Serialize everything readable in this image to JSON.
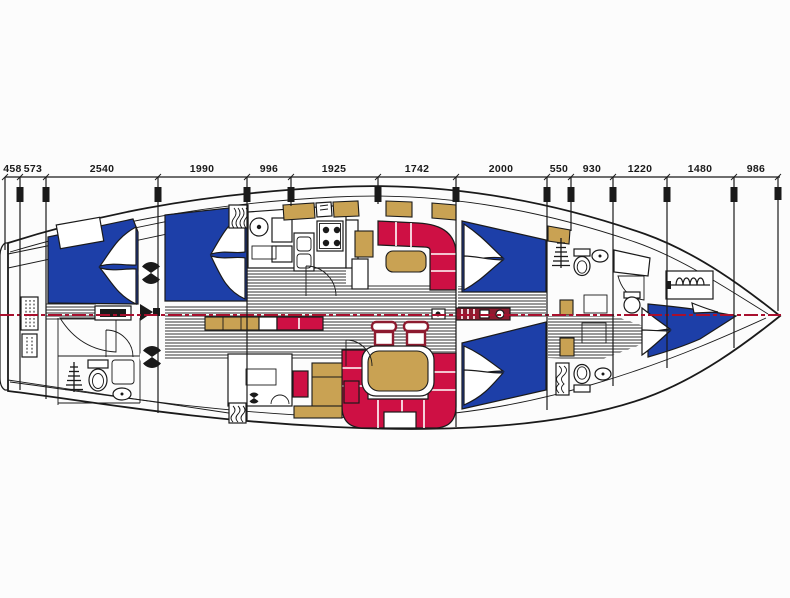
{
  "diagram": {
    "type": "sailing-yacht-interior-layout-plan",
    "view": "top-down",
    "dimension_labels": [
      "458",
      "573",
      "2540",
      "1990",
      "996",
      "1925",
      "1742",
      "2000",
      "550",
      "930",
      "1220",
      "1480",
      "986"
    ],
    "icons": [
      "helm-wheel",
      "companionway-ladder",
      "toilet",
      "wash-basin",
      "sink",
      "stove-burners",
      "shower-grate",
      "windlass-chain",
      "mast",
      "vent-coil",
      "speaker",
      "deck-fitting"
    ]
  },
  "colors": {
    "background": "#fcfcfc",
    "hull_line": "#1a1a1a",
    "berth_blue": "#1d3fa8",
    "settee_red": "#ce1044",
    "wood_tan": "#c9a253",
    "mast_red": "#8d1b2f",
    "centerline_red": "#a8102e"
  }
}
